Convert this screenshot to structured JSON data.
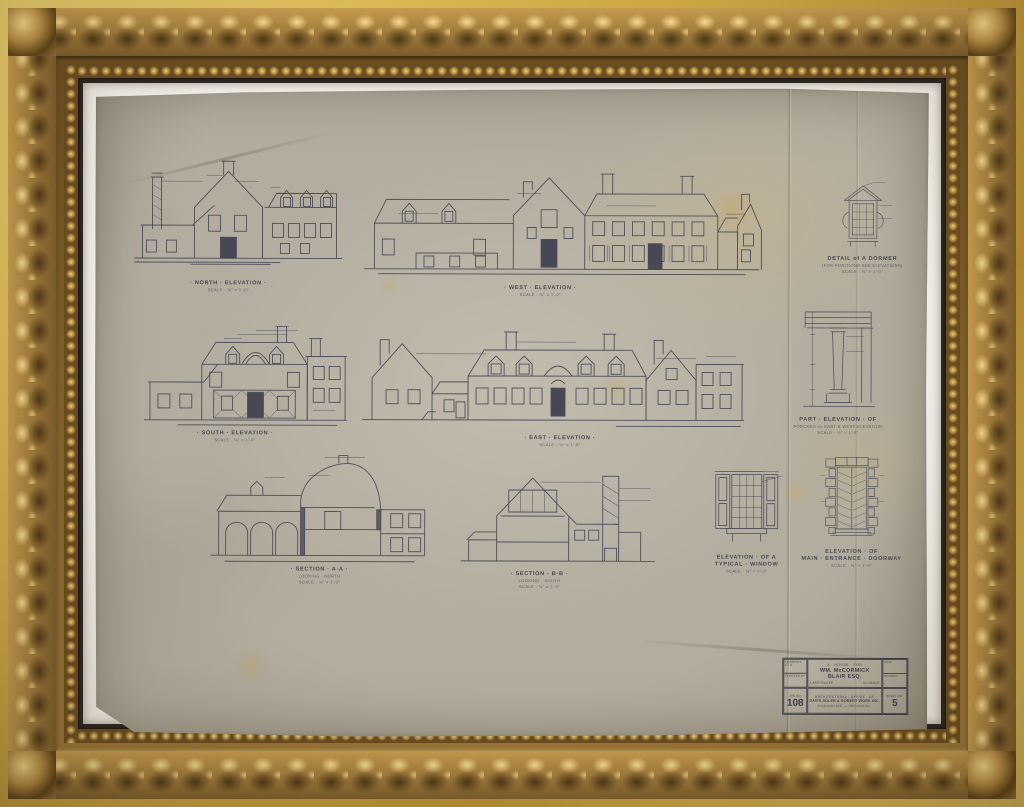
{
  "artwork": {
    "type_label": "framed architectural blueprint",
    "colors": {
      "frame_gold": "#c69c4e",
      "frame_shadow": "#5e4218",
      "mat_white": "#f1efe8",
      "paper_aged": "#b3ada0",
      "ink": "#4d4e59"
    }
  },
  "drawings": {
    "north": {
      "title": "· NORTH · ELEVATION ·",
      "scale": "SCALE · ⅛″ = 1′-0″"
    },
    "west": {
      "title": "· WEST · ELEVATION ·",
      "scale": "SCALE · ⅛″ = 1′-0″"
    },
    "south": {
      "title": "· SOUTH · ELEVATION ·",
      "scale": "SCALE · ⅛″ = 1′-0″"
    },
    "east": {
      "title": "· EAST · ELEVATION ·",
      "scale": "SCALE · ⅛″ = 1′-0″"
    },
    "secA": {
      "title": "· SECTION · A-A ·",
      "note": "LOOKING · NORTH",
      "scale": "SCALE · ⅛″ = 1′-0″"
    },
    "secB": {
      "title": "· SECTION · B-B ·",
      "note": "LOOKING · SOUTH",
      "scale": "SCALE · ⅛″ = 1′-0″"
    },
    "dormer": {
      "title": "DETAIL of A DORMER",
      "note": "(FOR POSITIONS SEE ELEVATIONS)",
      "scale": "SCALE · ¾″ = 1′-0″"
    },
    "porch": {
      "title": "PART · ELEVATION · OF",
      "note": "PORCHES on EAST & WEST ELEVATION",
      "scale": "SCALE · ¾″ = 1′-0″"
    },
    "window": {
      "title": "ELEVATION · OF A",
      "note": "TYPICAL · WINDOW",
      "scale": "SCALE · ¾″ = 1′-0″"
    },
    "door": {
      "title": "ELEVATION · OF",
      "note": "MAIN · ENTRANCE · DOORWAY",
      "scale": "SCALE · ¾″ = 1′-0″"
    }
  },
  "title_block": {
    "house_for": "· A · HOUSE · FOR ·",
    "client": "WM. McCORMICK BLAIR ESQ.",
    "city": "LAKE BLUFF",
    "state": "ILLINOIS",
    "drawn_by_label": "DRAWN BY",
    "drawn_by": "F.T.A.",
    "checked_label": "CHECKED BY",
    "date_label": "DATE",
    "revised_label": "REVISED",
    "job_label": "JOB NO.",
    "job_no": "108",
    "office_line1": "· ARCHITECTURAL · OFFICE · OF ·",
    "office_line2": "DAVID ADLER & ROBERT WORK INC.",
    "office_line3": "MICHIGAN AVE. — CHICAGO ILL.",
    "sheet_label": "SHEET NO.",
    "sheet_no": "5"
  }
}
